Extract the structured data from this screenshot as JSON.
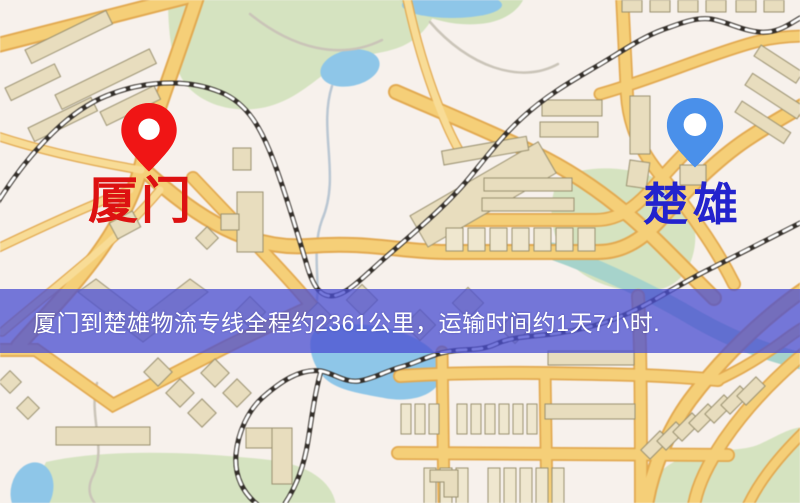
{
  "map": {
    "origin": {
      "name": "厦门",
      "pin_color": "#f01515",
      "label_color": "#dd1111"
    },
    "destination": {
      "name": "楚雄",
      "pin_color": "#4a90ea",
      "label_color": "#2323cd"
    },
    "banner": {
      "text": "厦门到楚雄物流专线全程约2361公里，运输时间约1天7小时.",
      "background": "rgba(75,79,209,0.76)",
      "text_color": "#ffffff",
      "distance_km": "2361",
      "duration": "1天7小时"
    }
  }
}
